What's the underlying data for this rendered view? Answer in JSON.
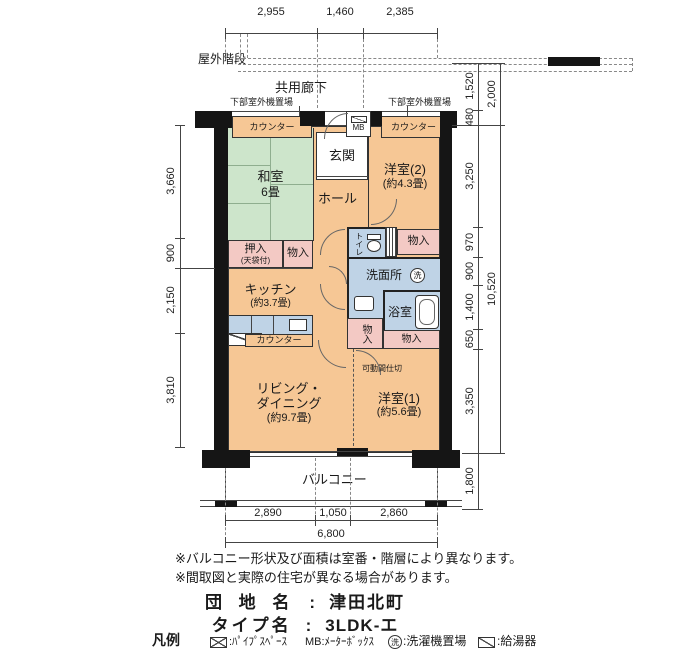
{
  "colors": {
    "room_orange": "#f6c795",
    "tatami_green": "#cde5cb",
    "wet_blue": "#bfd3e6",
    "storage_pink": "#f3c9c4",
    "wall_black": "#151515"
  },
  "top_area": {
    "dims": [
      "2,955",
      "1,460",
      "2,385"
    ],
    "outdoor_stairs_label": "屋外階段",
    "shared_corridor_label": "共用廊下",
    "outdoor_unit_left_label": "下部室外機置場",
    "outdoor_unit_right_label": "下部室外機置場"
  },
  "side_dims": {
    "left": [
      "3,660",
      "900",
      "2,150",
      "3,810"
    ],
    "right_inner": [
      "1,520",
      "480",
      "3,250",
      "970",
      "900",
      "1,400",
      "650",
      "3,350",
      "1,800"
    ],
    "right_outer": [
      "2,000",
      "10,520"
    ]
  },
  "bottom_dims": {
    "segments": [
      "2,890",
      "1,050",
      "2,860"
    ],
    "total": "6,800"
  },
  "rooms": {
    "counter_top_left": "カウンター",
    "counter_top_right": "カウンター",
    "meter_box": "MB",
    "entrance": "玄関",
    "hall": "ホール",
    "japanese_room": {
      "name": "和室",
      "size": "6畳"
    },
    "western_room_2": {
      "name": "洋室(2)",
      "size": "(約4.3畳)"
    },
    "closet_oshiire": {
      "name": "押入",
      "sub": "(天袋付)"
    },
    "storage_1": "物入",
    "storage_2": "物入",
    "storage_3": "物入",
    "storage_4": "物入",
    "kitchen": {
      "name": "キッチン",
      "size": "(約3.7畳)"
    },
    "kitchen_counter": "カウンター",
    "toilet": "トイレ",
    "washroom": "洗面所",
    "washer_symbol": "洗",
    "bathroom": "浴室",
    "living_dining": {
      "name1": "リビング・",
      "name2": "ダイニング",
      "size": "(約9.7畳)"
    },
    "movable_partition": "可動間仕切",
    "western_room_1": {
      "name": "洋室(1)",
      "size": "(約5.6畳)"
    },
    "balcony": "バルコニー"
  },
  "notes": [
    "※バルコニー形状及び面積は室番・階層により異なります。",
    "※間取図と実際の住宅が異なる場合があります。"
  ],
  "title_block": {
    "estate_label": "団 地 名",
    "estate_value": "津田北町",
    "type_label": "タイプ名",
    "type_value": "3LDK-エ",
    "separator": ":"
  },
  "legend": {
    "label": "凡例",
    "pipe_space_text": ":ﾊﾟｲﾌﾟｽﾍﾟｰｽ",
    "meter_box_text": "MB:ﾒｰﾀｰﾎﾞｯｸｽ",
    "washer_symbol": "洗",
    "washer_text": ":洗濯機置場",
    "heater_text": ":給湯器"
  }
}
